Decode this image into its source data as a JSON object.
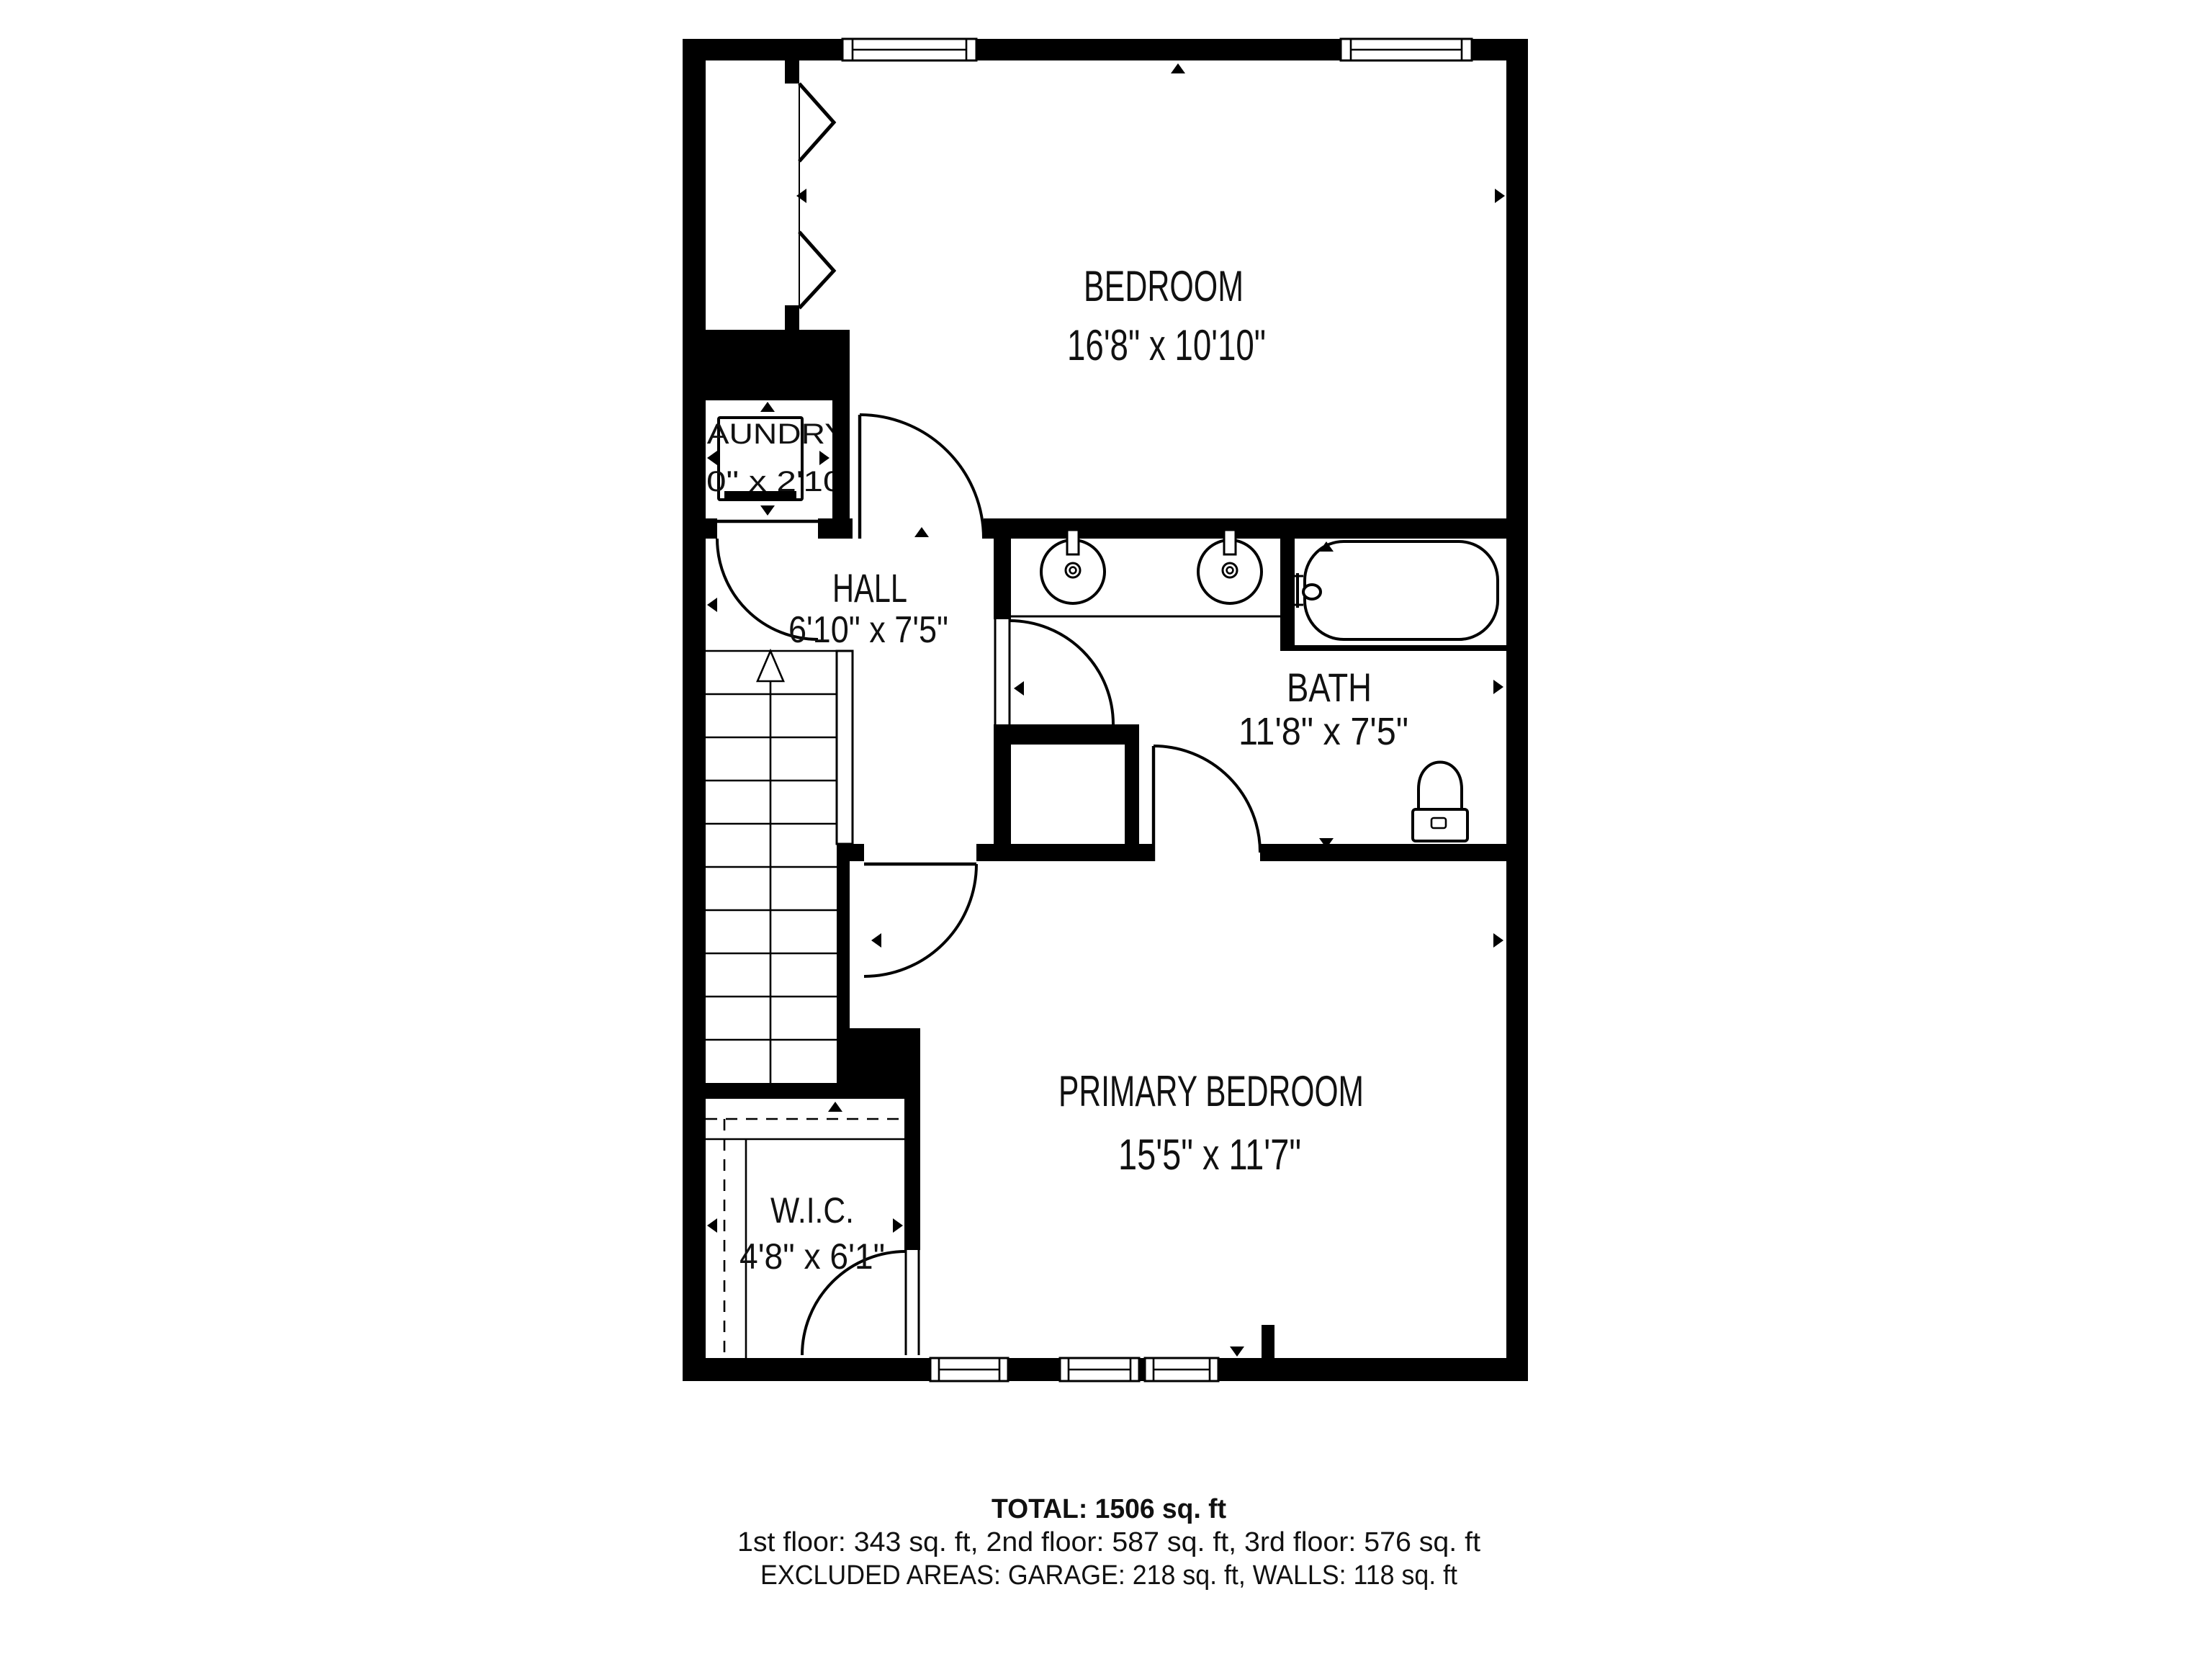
{
  "plan": {
    "rooms": {
      "bedroom": {
        "name": "BEDROOM",
        "dims": "16'8\" x 10'10\""
      },
      "laundry": {
        "name": "LAUNDRY",
        "dims": "3'0\" x 2'10\""
      },
      "hall": {
        "name": "HALL",
        "dims": "6'10\" x 7'5\""
      },
      "bath": {
        "name": "BATH",
        "dims": "11'8\" x 7'5\""
      },
      "primary": {
        "name": "PRIMARY BEDROOM",
        "dims": "15'5\" x 11'7\""
      },
      "wic": {
        "name": "W.I.C.",
        "dims": "4'8\" x 6'1\""
      }
    }
  },
  "footer": {
    "total": "TOTAL: 1506 sq. ft",
    "floors": "1st floor: 343 sq. ft, 2nd floor: 587 sq. ft, 3rd floor: 576 sq. ft",
    "excluded": "EXCLUDED AREAS: GARAGE: 218 sq. ft, WALLS: 118 sq. ft"
  },
  "colors": {
    "wall": "#000000",
    "background": "#ffffff",
    "text": "#111111"
  }
}
